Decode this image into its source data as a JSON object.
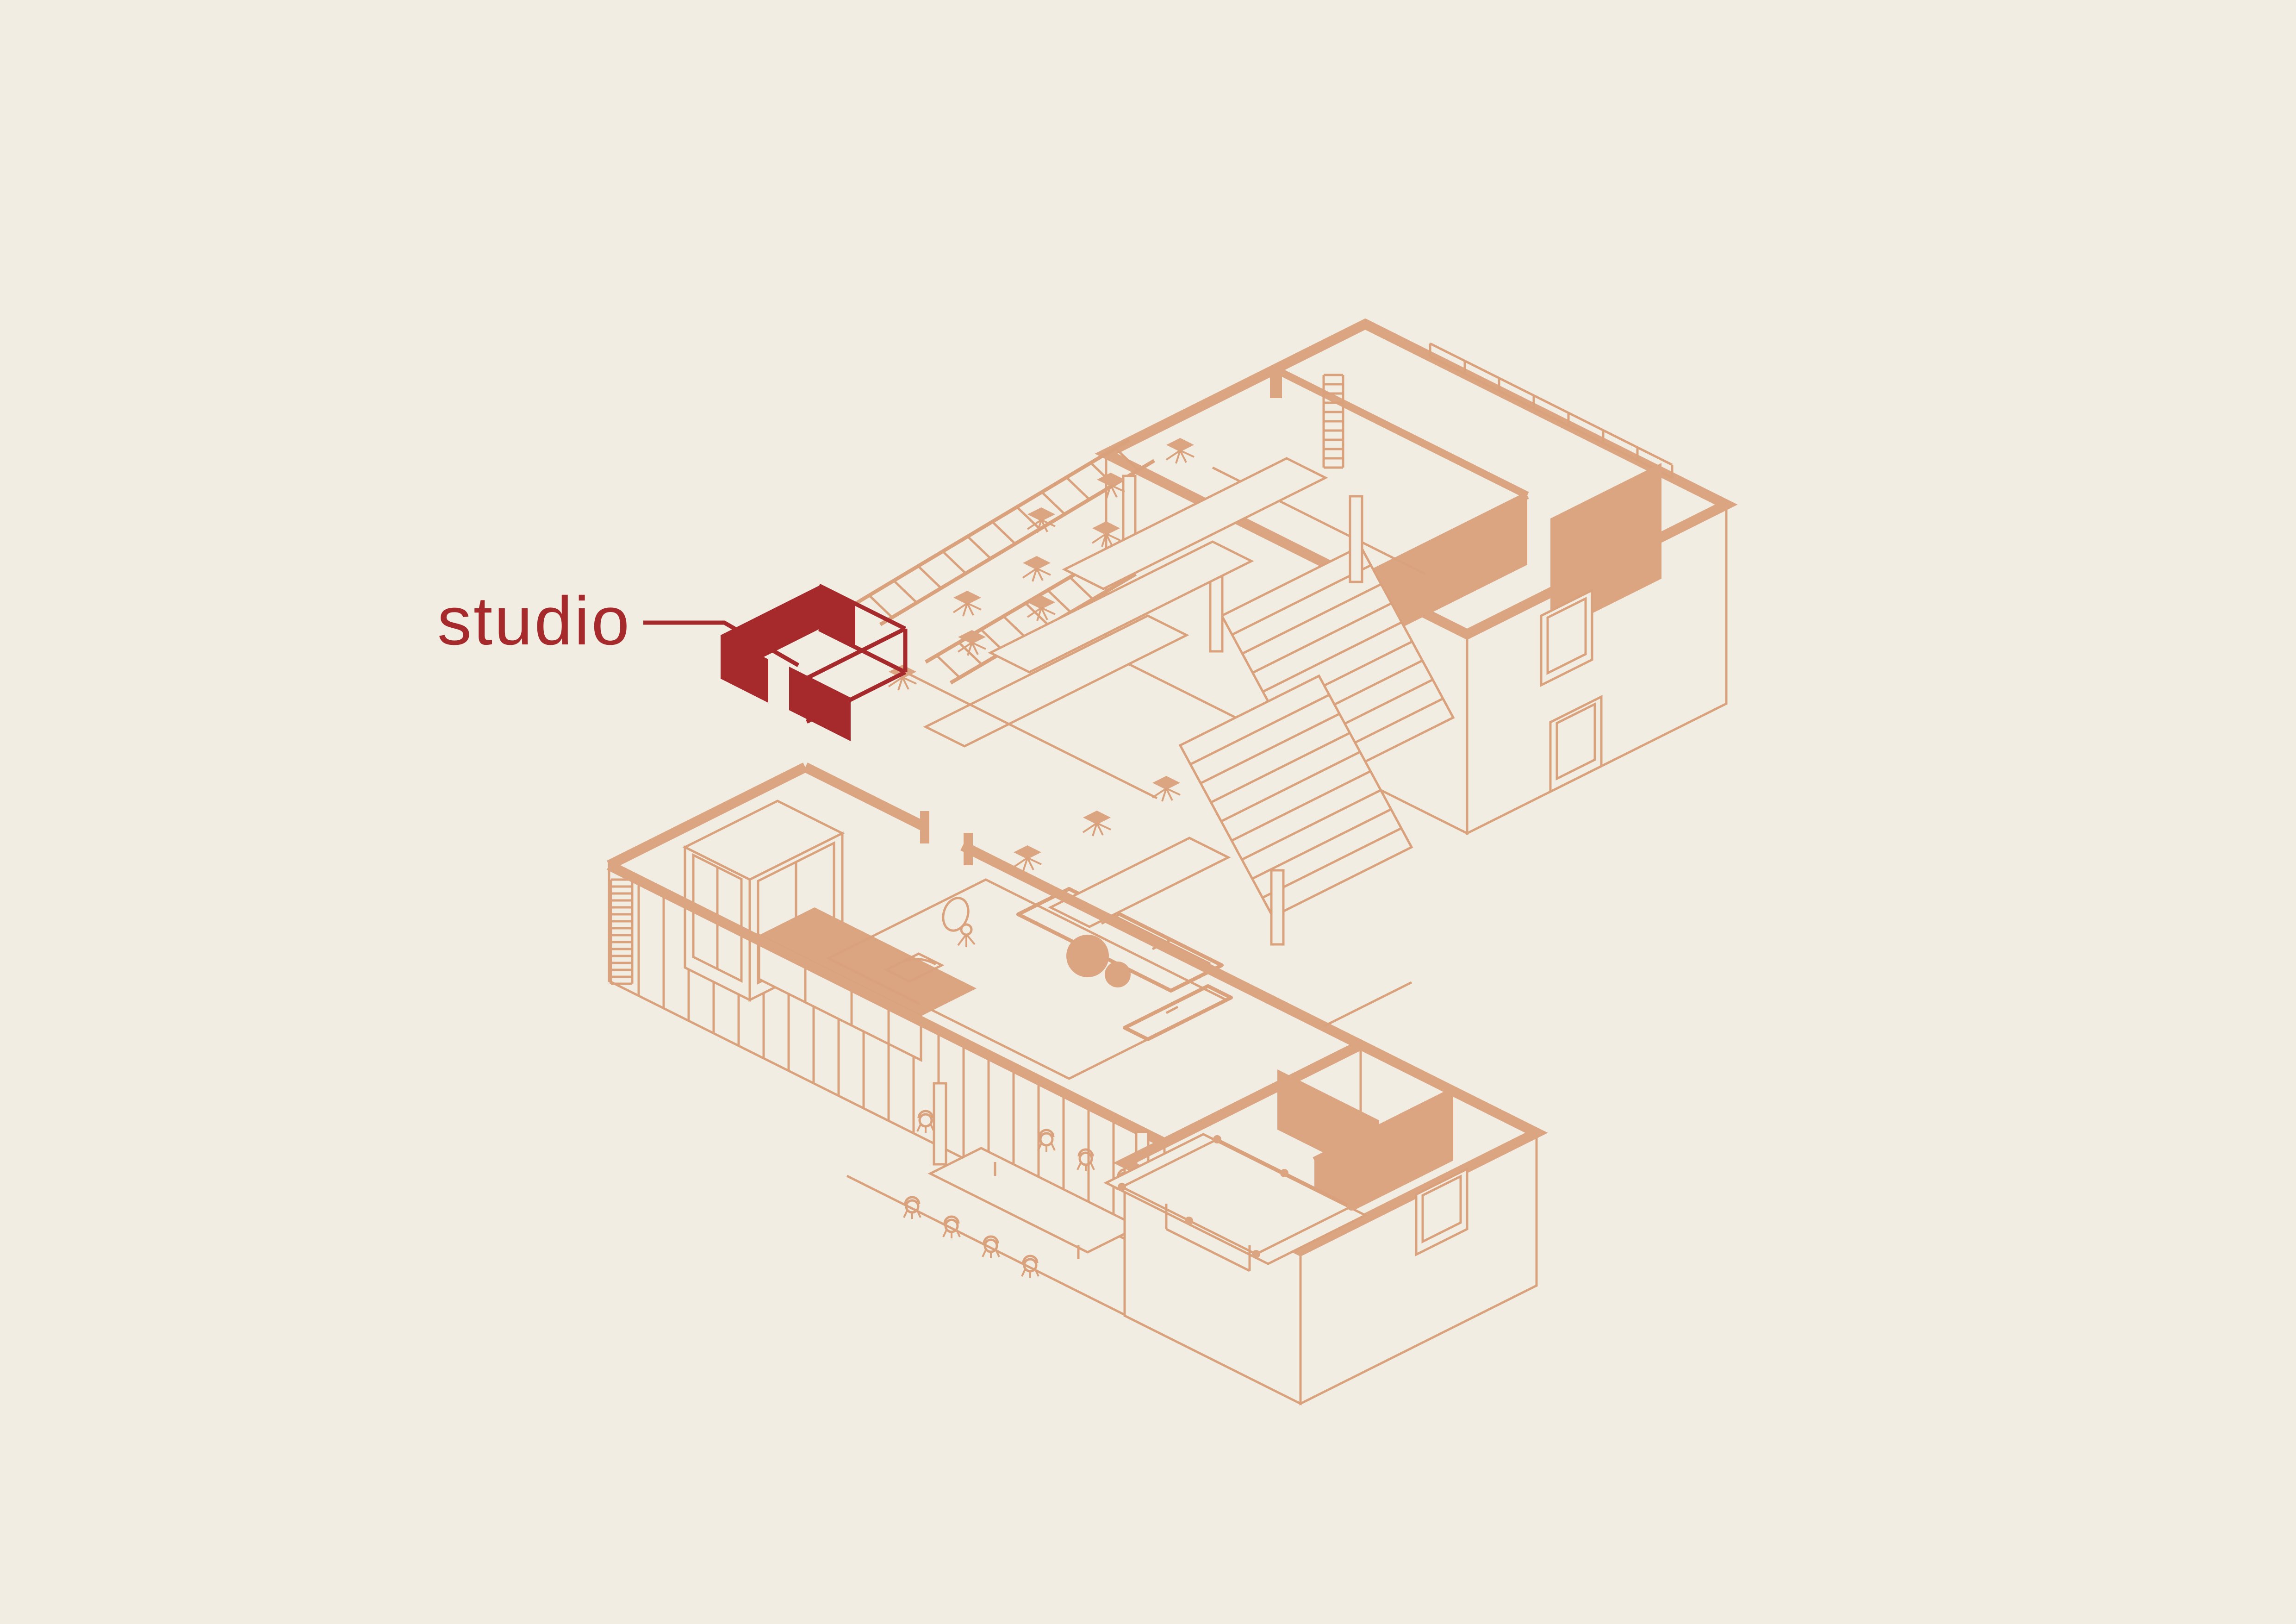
{
  "annotation": {
    "label": "studio"
  },
  "colors": {
    "bg": "#F2EDE3",
    "line": "#D9A17C",
    "wall": "#DCA582",
    "accent": "#A6292C"
  },
  "drawing": {
    "type": "isometric-floor-plan",
    "highlighted_room": "studio"
  }
}
